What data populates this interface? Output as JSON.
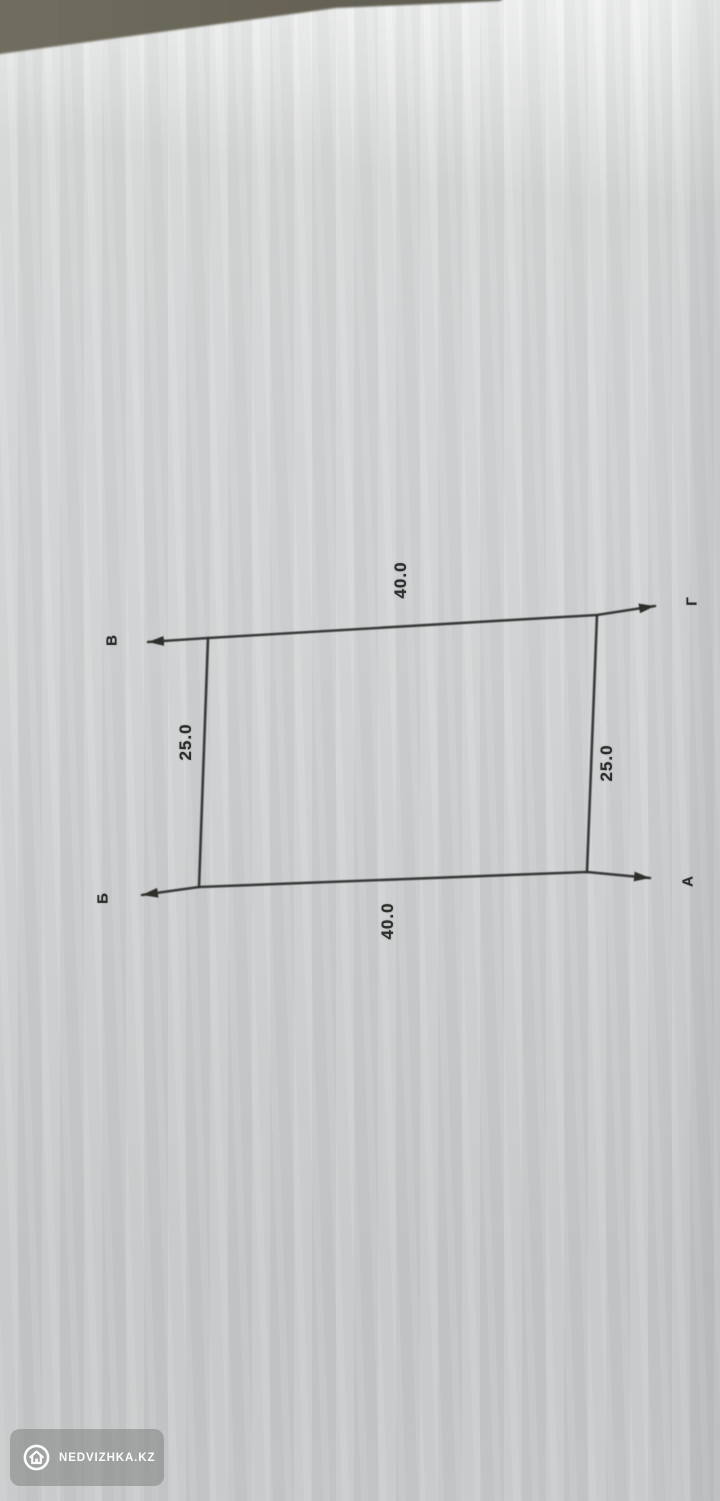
{
  "photo": {
    "description": "photographed paper sketch of a rectangular land plot",
    "watermark": {
      "label": "NEDVIZHKA.KZ",
      "icon": "house-icon"
    }
  },
  "plot_diagram": {
    "type": "land-plot-outline",
    "corners": [
      {
        "position": "top-left",
        "label": "В"
      },
      {
        "position": "top-right",
        "label": "Г"
      },
      {
        "position": "bottom-right",
        "label": "А"
      },
      {
        "position": "bottom-left",
        "label": "Б"
      }
    ],
    "dimensions": [
      {
        "side": "top",
        "value": "40.0"
      },
      {
        "side": "bottom",
        "value": "40.0"
      },
      {
        "side": "left",
        "value": "25.0"
      },
      {
        "side": "right",
        "value": "25.0"
      }
    ],
    "colors": {
      "line": "#2e2e2c",
      "paper": "#d3d5d6",
      "table_surface": "#6b685b",
      "watermark_pill": "#9fa19f",
      "watermark_text": "#fbfbfb"
    }
  }
}
